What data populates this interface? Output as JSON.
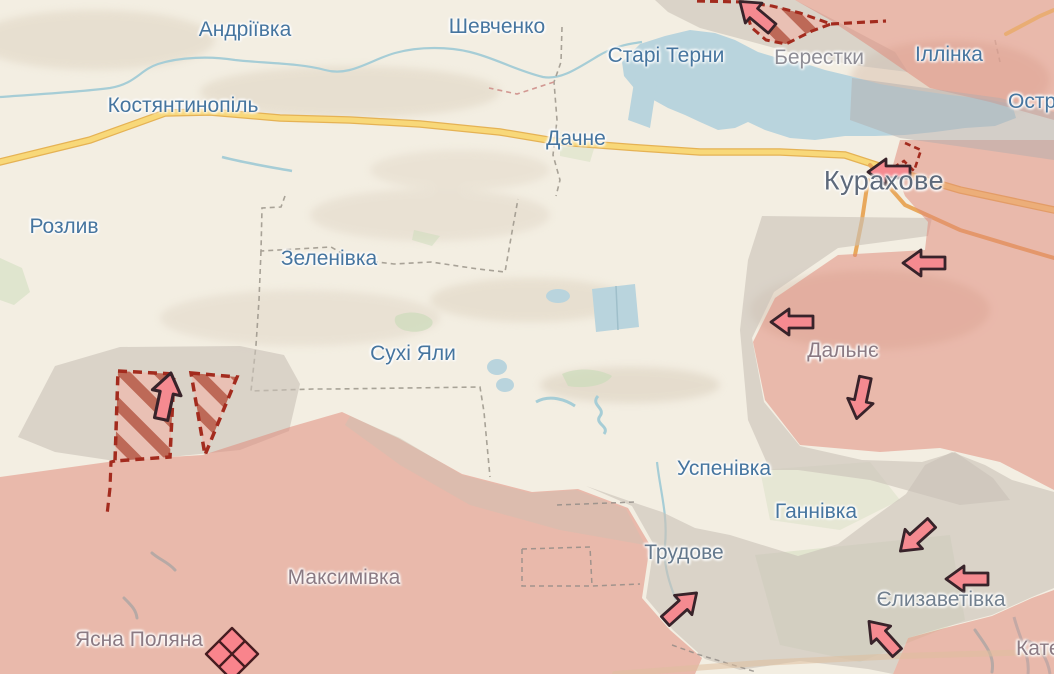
{
  "map": {
    "region": "Kurakhove direction",
    "language": "uk"
  },
  "settlements": [
    {
      "name": "Андріївка",
      "kind": "town"
    },
    {
      "name": "Шевченко",
      "kind": "town"
    },
    {
      "name": "Старі Терни",
      "kind": "town"
    },
    {
      "name": "Берестки",
      "kind": "town"
    },
    {
      "name": "Іллінка",
      "kind": "town"
    },
    {
      "name": "Остр",
      "kind": "town-clipped"
    },
    {
      "name": "Костянтинопіль",
      "kind": "town"
    },
    {
      "name": "Дачне",
      "kind": "town"
    },
    {
      "name": "Курахове",
      "kind": "city"
    },
    {
      "name": "Розлив",
      "kind": "town"
    },
    {
      "name": "Зеленівка",
      "kind": "town"
    },
    {
      "name": "Дальнє",
      "kind": "town"
    },
    {
      "name": "Сухі Яли",
      "kind": "town"
    },
    {
      "name": "Успенівка",
      "kind": "town"
    },
    {
      "name": "Ганнівка",
      "kind": "town"
    },
    {
      "name": "Трудове",
      "kind": "town"
    },
    {
      "name": "Єлизаветівка",
      "kind": "town"
    },
    {
      "name": "Максимівка",
      "kind": "town"
    },
    {
      "name": "Ясна Поляна",
      "kind": "town"
    },
    {
      "name": "Катер",
      "kind": "town-clipped"
    }
  ],
  "map_symbols": {
    "attack_arrows": [
      {
        "direction": "northwest",
        "near": "Берестки"
      },
      {
        "direction": "west",
        "near": "Курахове"
      },
      {
        "direction": "west",
        "near": "north of Дальнє"
      },
      {
        "direction": "west",
        "near": "Дальнє"
      },
      {
        "direction": "south",
        "near": "south of Дальнє"
      },
      {
        "direction": "southwest",
        "near": "north of Єлизаветівка"
      },
      {
        "direction": "west",
        "near": "Єлизаветівка"
      },
      {
        "direction": "northeast",
        "near": "Трудове"
      },
      {
        "direction": "northwest",
        "near": "south of Єлизаветівка"
      },
      {
        "direction": "north",
        "near": "hatched pocket west of Сухі Яли"
      }
    ],
    "hatched_advance_areas": 3,
    "diamond_marker": {
      "near": "Ясна Поляна"
    }
  },
  "colors": {
    "background": "#f3eee2",
    "occupied_fill": "#e08878",
    "grey_zone_fill": "#c9c2b8",
    "water": "#b9d4dd",
    "river": "#a6cdd6",
    "road_major": "#f8d879",
    "road_major_casing": "#e5b254",
    "road_secondary": "#e8a85c",
    "advance_dashed": "#a32b1e",
    "hatch_stripe": "#b85f4d",
    "arrow_fill": "#f58a90",
    "arrow_outline": "#38232a",
    "label_default": "#46759f",
    "label_city": "#5e6a7b"
  }
}
